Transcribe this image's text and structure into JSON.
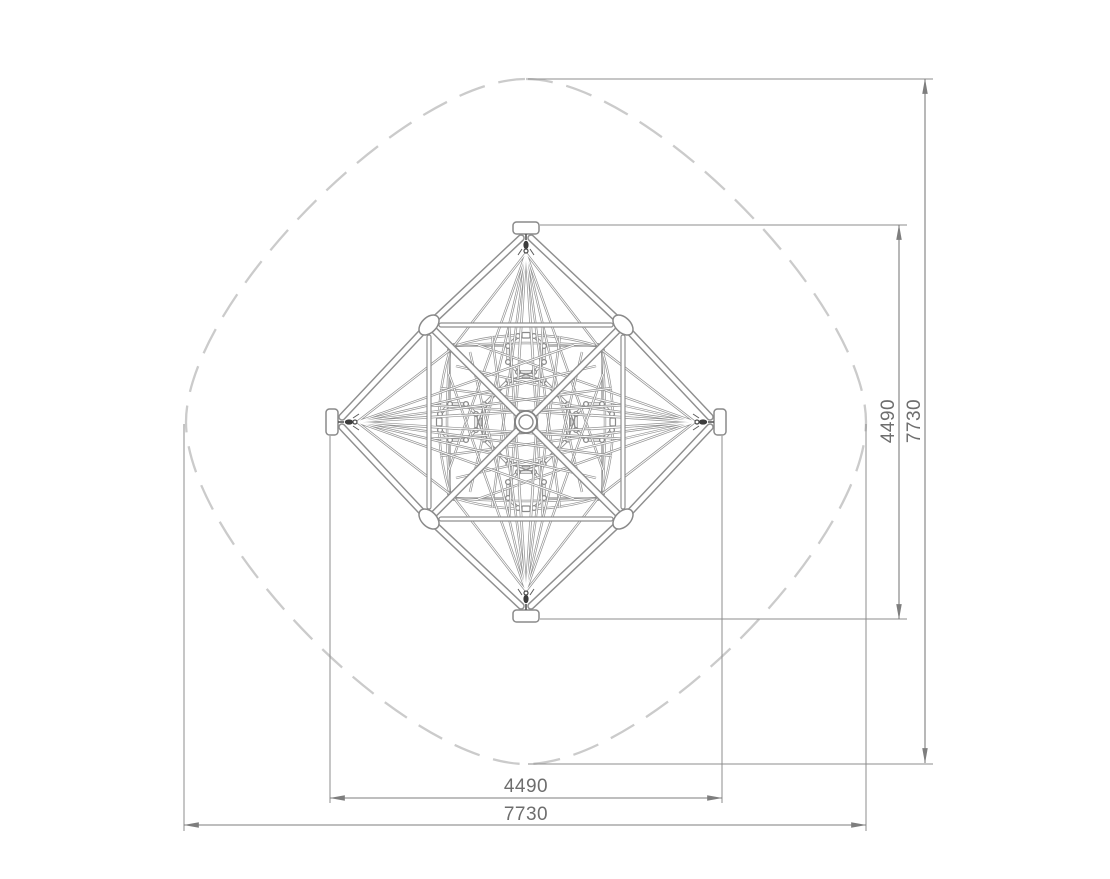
{
  "dimensions": {
    "h_inner": {
      "label": "4490"
    },
    "h_outer": {
      "label": "7730"
    },
    "v_inner": {
      "label": "4490"
    },
    "v_outer": {
      "label": "7730"
    }
  },
  "colors": {
    "background": "#ffffff",
    "frame_outline": "#8f8f8f",
    "rope": "#919191",
    "safety_zone_dash": "#cbcbcb",
    "dimension_line": "#7e7e7e",
    "dimension_text": "#6e6e6e",
    "connector_dark": "#3d3d3d"
  }
}
